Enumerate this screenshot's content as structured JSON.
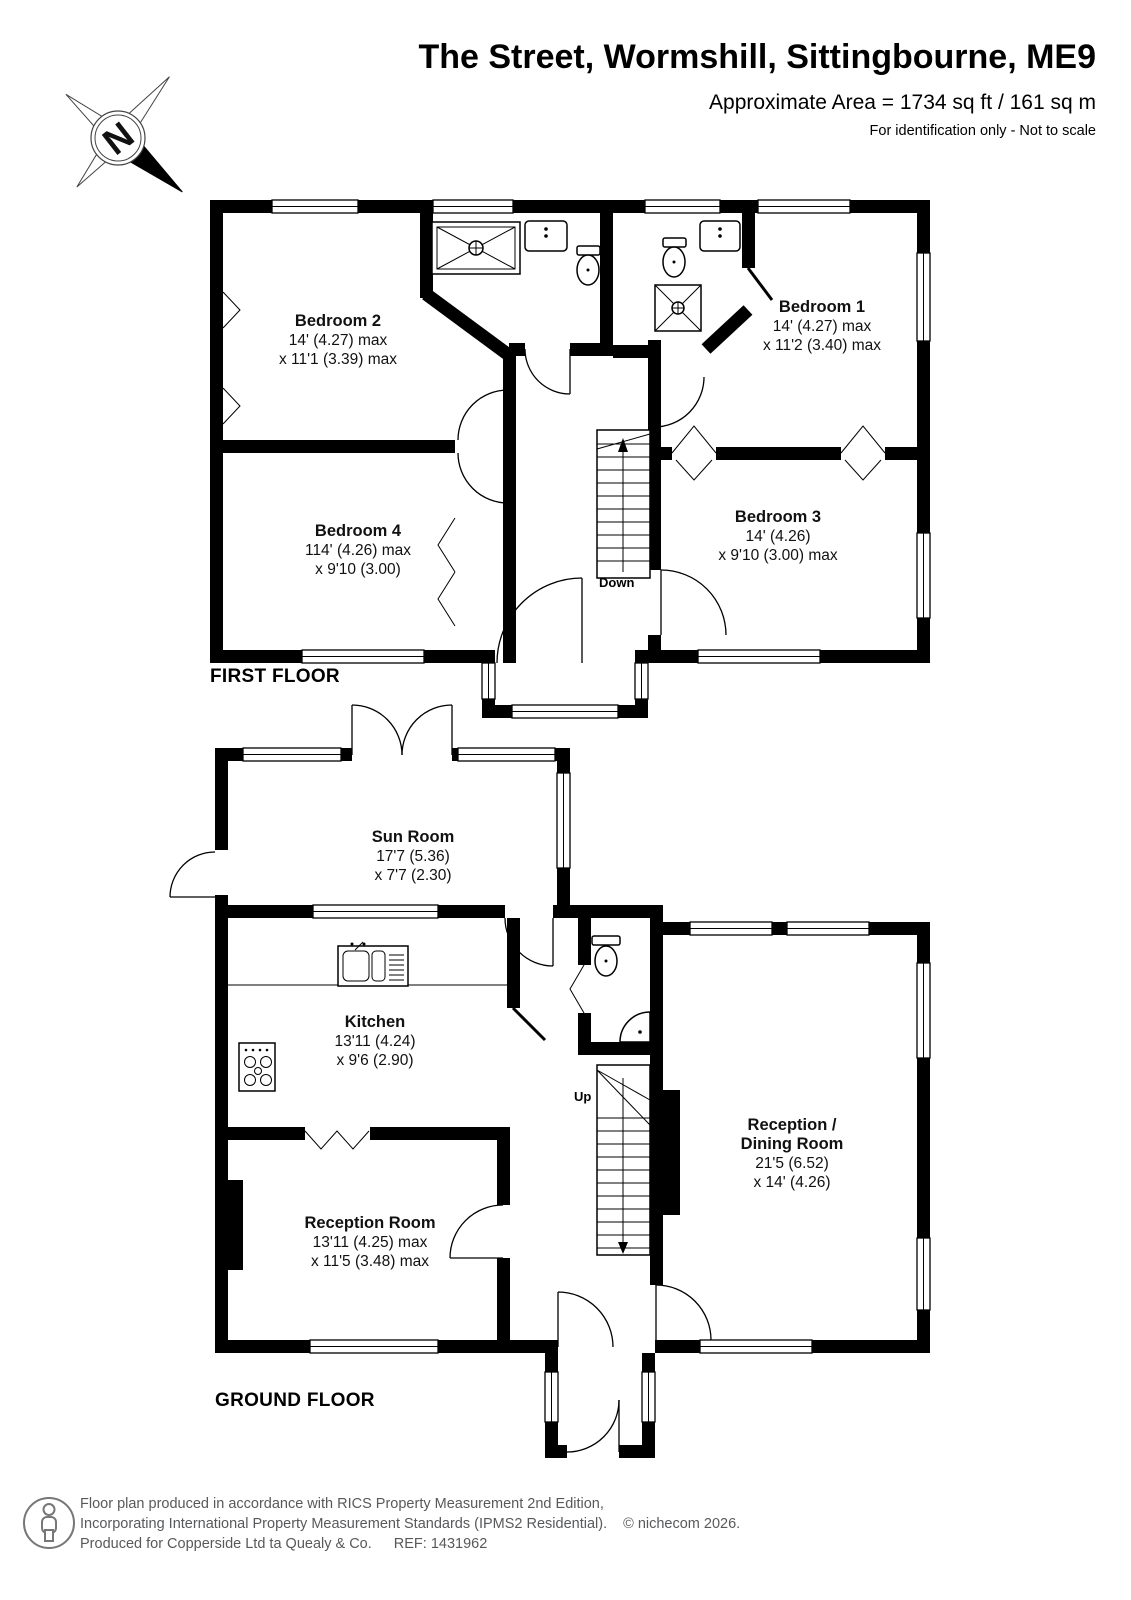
{
  "header": {
    "title": "The Street, Wormshill, Sittingbourne, ME9",
    "area_line": "Approximate Area = 1734 sq ft / 161 sq m",
    "note_line": "For identification only - Not to scale"
  },
  "compass": {
    "north_label": "N"
  },
  "first_floor": {
    "label": "FIRST FLOOR",
    "stairs_label": "Down",
    "rooms": {
      "bedroom2": {
        "name": "Bedroom 2",
        "dim1": "14' (4.27) max",
        "dim2": "x 11'1 (3.39) max"
      },
      "bedroom1": {
        "name": "Bedroom 1",
        "dim1": "14' (4.27) max",
        "dim2": "x 11'2 (3.40) max"
      },
      "bedroom4": {
        "name": "Bedroom 4",
        "dim1": "114' (4.26) max",
        "dim2": "x 9'10 (3.00)"
      },
      "bedroom3": {
        "name": "Bedroom 3",
        "dim1": "14' (4.26)",
        "dim2": "x 9'10 (3.00) max"
      }
    }
  },
  "ground_floor": {
    "label": "GROUND FLOOR",
    "stairs_label": "Up",
    "rooms": {
      "sun_room": {
        "name": "Sun Room",
        "dim1": "17'7 (5.36)",
        "dim2": "x 7'7 (2.30)"
      },
      "kitchen": {
        "name": "Kitchen",
        "dim1": "13'11 (4.24)",
        "dim2": "x 9'6 (2.90)"
      },
      "reception_room": {
        "name": "Reception Room",
        "dim1": "13'11 (4.25) max",
        "dim2": "x 11'5 (3.48) max"
      },
      "reception_dining_room": {
        "name": "Reception /",
        "name2": "Dining Room",
        "dim1": "21'5 (6.52)",
        "dim2": "x 14' (4.26)"
      }
    }
  },
  "footer": {
    "line1": "Floor plan produced in accordance with RICS Property Measurement 2nd Edition,",
    "line2": "Incorporating International Property Measurement Standards (IPMS2 Residential).",
    "copyright": "© nichecom 2026.",
    "line3": "Produced for Copperside Ltd ta Quealy & Co.",
    "ref": "REF: 1431962"
  }
}
